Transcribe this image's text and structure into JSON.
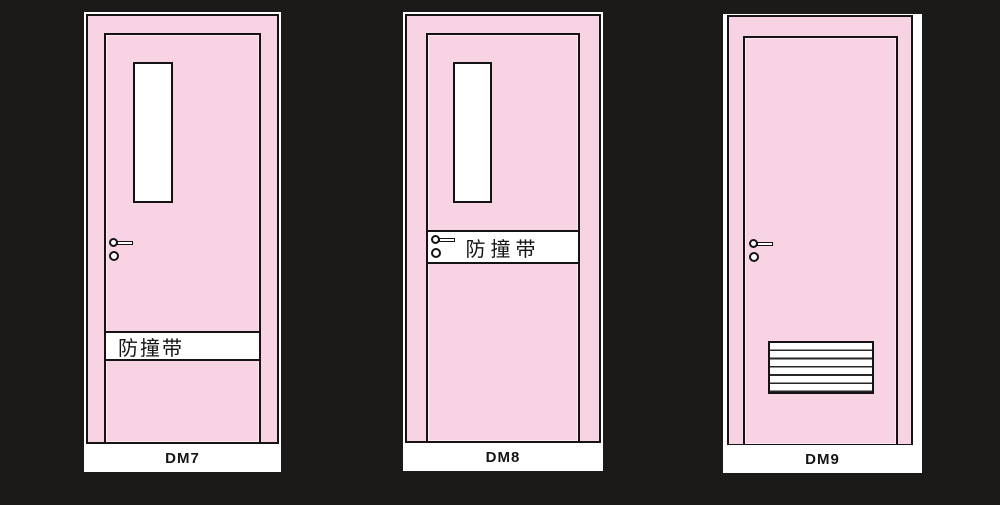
{
  "colors": {
    "background": "#1c1919",
    "door_pink": "#f8d3e3",
    "outline": "#161314",
    "card_white": "#ffffff"
  },
  "doors": [
    {
      "code": "DM7",
      "band_label": "防撞带",
      "features": "window, handle, impact-strip lower"
    },
    {
      "code": "DM8",
      "band_label": "防撞带",
      "features": "window, impact-strip middle with handle"
    },
    {
      "code": "DM9",
      "features": "handle, louver vent"
    }
  ]
}
